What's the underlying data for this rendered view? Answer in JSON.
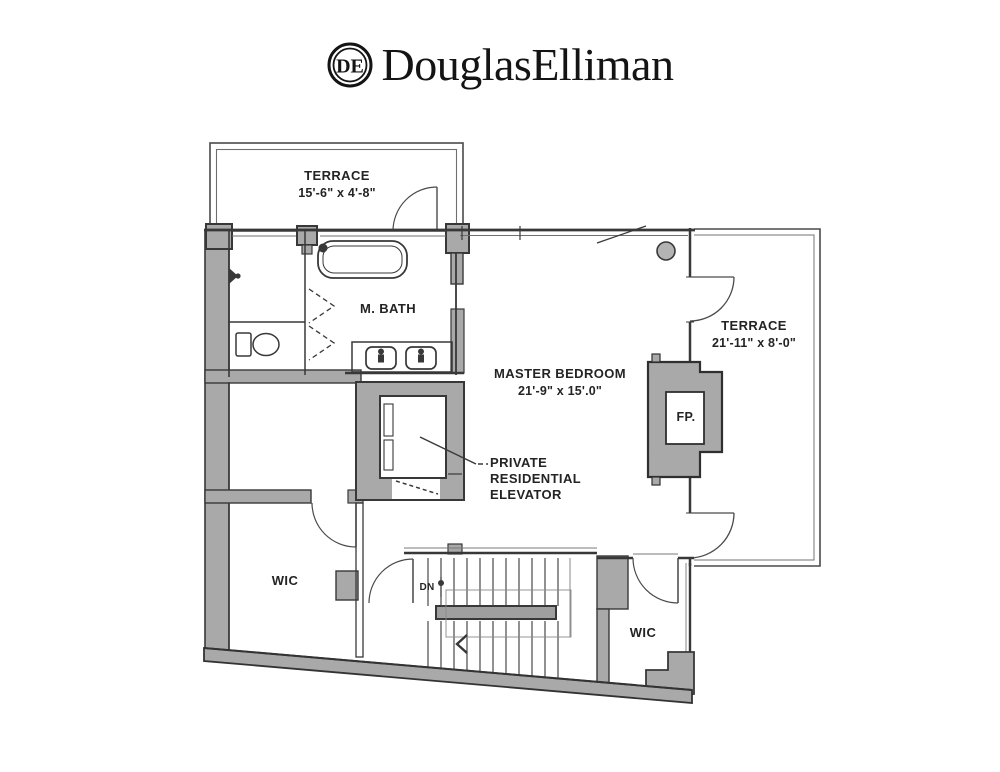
{
  "header": {
    "brand": "DouglasElliman",
    "logo_monogram": "DE"
  },
  "floorplan": {
    "terrace_top": {
      "name": "TERRACE",
      "dims": "15'-6\" x 4'-8\""
    },
    "master_bath": {
      "name": "M. BATH"
    },
    "master_bedroom": {
      "name": "MASTER BEDROOM",
      "dims": "21'-9\" x 15'.0\""
    },
    "terrace_right": {
      "name": "TERRACE",
      "dims": "21'-11\" x 8'-0\""
    },
    "fireplace": {
      "label": "FP."
    },
    "elevator_label": {
      "line1": "PRIVATE",
      "line2": "RESIDENTIAL",
      "line3": "ELEVATOR"
    },
    "wic_left": {
      "name": "WIC"
    },
    "wic_right": {
      "name": "WIC"
    },
    "stairs": {
      "down_label": "DN"
    },
    "colors": {
      "wall_fill": "#a9a9a9",
      "wall_line": "#383838",
      "ink": "#242424"
    }
  }
}
